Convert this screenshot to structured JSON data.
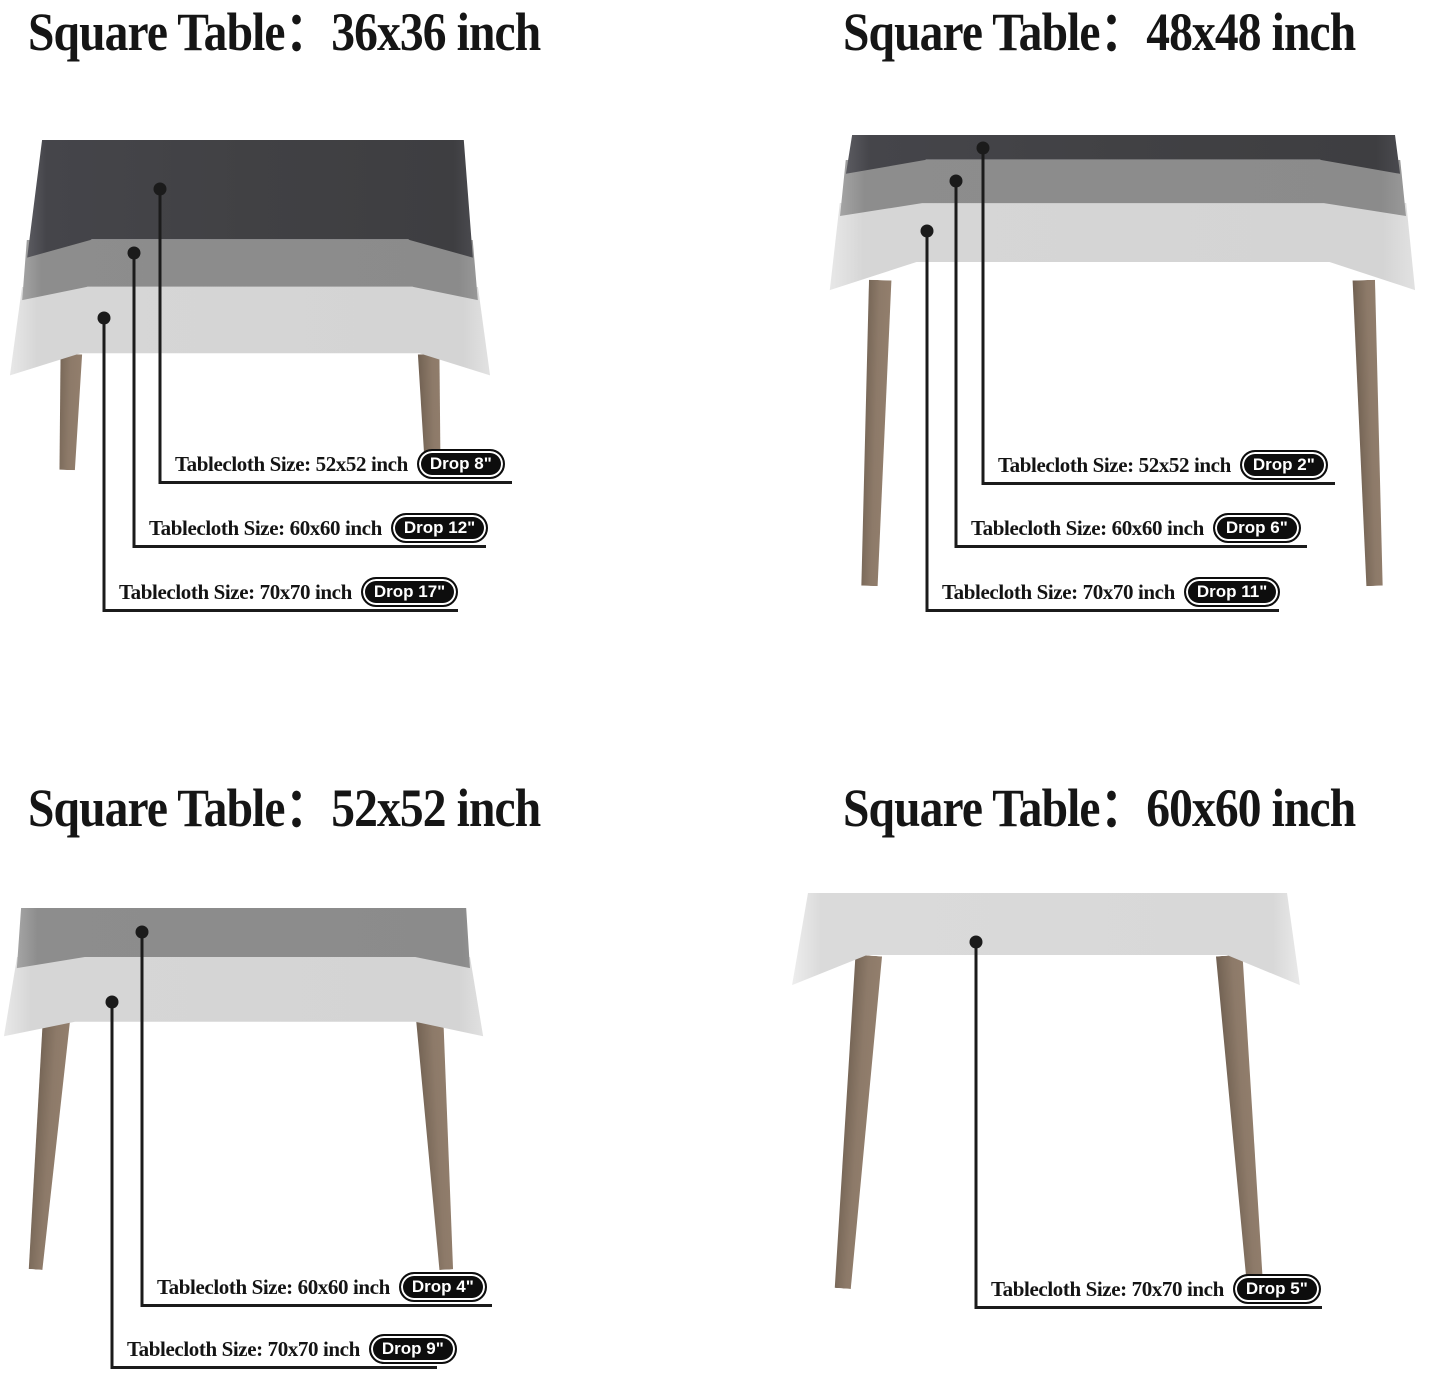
{
  "document": {
    "kind": "tablecloth-size-guide",
    "background": "#ffffff"
  },
  "colors": {
    "cloth_dark": "#414144",
    "cloth_medium": "#8b8b8b",
    "cloth_light": "#d6d6d6",
    "table_leg": "#8d7a69",
    "text": "#141414",
    "pill_background": "#0d0d0d",
    "pill_text": "#ffffff",
    "callout_line": "#1b1b1b"
  },
  "panels": [
    {
      "id": "square-table-36x36",
      "title": "Square Table：36x36 inch",
      "callouts": [
        {
          "label": "Tablecloth Size: 52x52 inch",
          "drop": "Drop 8\""
        },
        {
          "label": "Tablecloth Size: 60x60 inch",
          "drop": "Drop 12\""
        },
        {
          "label": "Tablecloth Size: 70x70 inch",
          "drop": "Drop 17\""
        }
      ]
    },
    {
      "id": "square-table-48x48",
      "title": "Square Table：48x48 inch",
      "callouts": [
        {
          "label": "Tablecloth Size: 52x52 inch",
          "drop": "Drop 2\""
        },
        {
          "label": "Tablecloth Size: 60x60 inch",
          "drop": "Drop 6\""
        },
        {
          "label": "Tablecloth Size: 70x70 inch",
          "drop": "Drop 11\""
        }
      ]
    },
    {
      "id": "square-table-52x52",
      "title": "Square Table：52x52 inch",
      "callouts": [
        {
          "label": "Tablecloth Size: 60x60 inch",
          "drop": "Drop 4\""
        },
        {
          "label": "Tablecloth Size: 70x70 inch",
          "drop": "Drop 9\""
        }
      ]
    },
    {
      "id": "square-table-60x60",
      "title": "Square Table：60x60 inch",
      "callouts": [
        {
          "label": "Tablecloth Size: 70x70 inch",
          "drop": "Drop 5\""
        }
      ]
    }
  ]
}
